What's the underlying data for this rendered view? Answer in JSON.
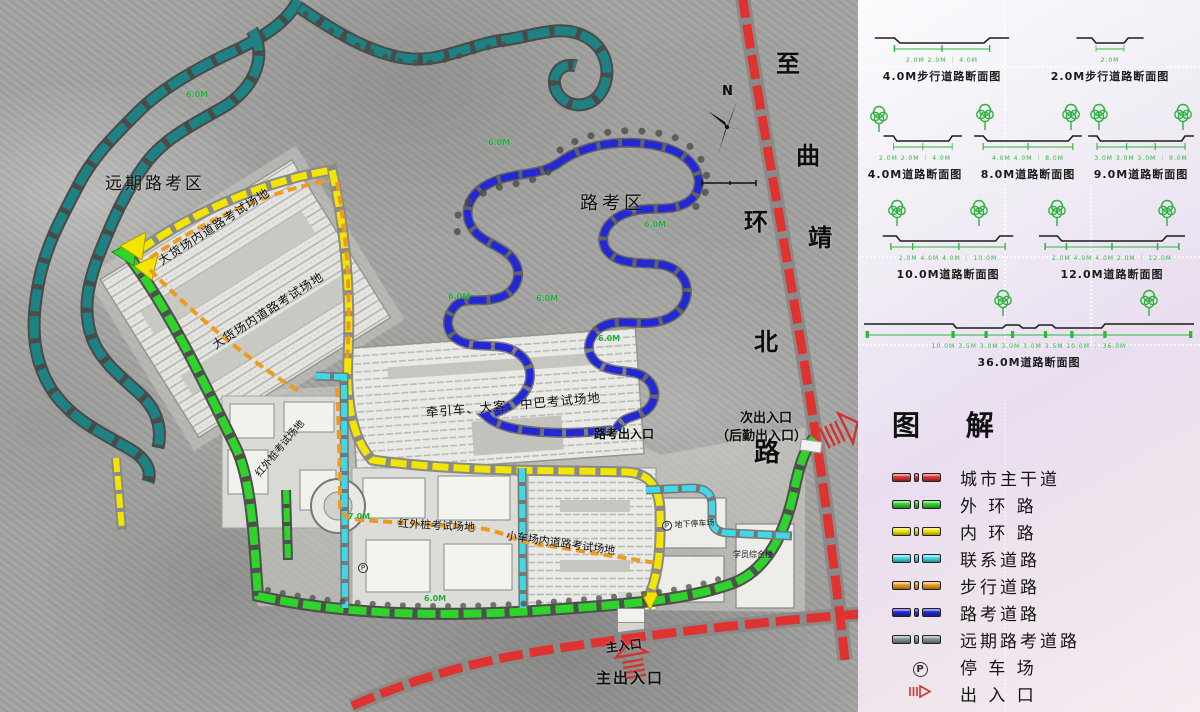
{
  "map": {
    "north_label": "N",
    "parking_symbol": "P",
    "region_labels": {
      "future_test_area": "远期路考区",
      "road_test_area": "路考区",
      "truck_field_a": "大货场内道路考试场地",
      "truck_field_b": "大货场内道路考试场地",
      "tractor_bus_field": "牵引车、大客、中巴考试场地",
      "infrared_pile_field_a": "红外桩考试场地",
      "infrared_pile_field_b": "红外桩考试场地",
      "small_car_field": "小车场内道路考试场地",
      "underground_parking": "地下停车场",
      "student_building": "学员综合楼"
    },
    "road_name": {
      "full": "至曲靖环北路",
      "chars": [
        "至",
        "曲",
        "环",
        "靖",
        "北",
        "路"
      ]
    },
    "entrance_labels": {
      "secondary_line1": "次出入口",
      "secondary_line2": "（后勤出入口）",
      "road_test_exit": "路考出入口",
      "main_gate": "主入口",
      "main_entrance": "主出入口"
    },
    "dimension_labels": [
      "6.0M",
      "6.0M",
      "6.0M",
      "6.0M",
      "6.0M",
      "7.0M",
      "6.0M",
      "6.0M"
    ]
  },
  "panel": {
    "sections": [
      {
        "label": "4.0M步行道路断面图",
        "dims": "2.0M  2.0M ｜ 4.0M"
      },
      {
        "label": "2.0M步行道路断面图",
        "dims": "2.0M"
      },
      {
        "label": "4.0M道路断面图",
        "dims": "2.0M 2.0M ｜ 4.0M"
      },
      {
        "label": "8.0M道路断面图",
        "dims": "4.0M 4.0M ｜ 8.0M"
      },
      {
        "label": "9.0M道路断面图",
        "dims": "3.0M 3.0M 3.0M ｜ 9.0M"
      },
      {
        "label": "10.0M道路断面图",
        "dims": "2.0M 4.0M 4.0M ｜ 10.0M"
      },
      {
        "label": "12.0M道路断面图",
        "dims": "2.0M 4.0M 4.0M 2.0M ｜ 12.0M"
      },
      {
        "label": "36.0M道路断面图",
        "dims": "10.0M 3.5M 3.0M 3.0M 3.0M 3.5M 10.0M ｜ 36.0M"
      }
    ],
    "legend": {
      "title": "图  解",
      "items": [
        {
          "label": "城市主干道",
          "color": "#df3331",
          "type": "dash"
        },
        {
          "label": "外 环 路",
          "color": "#2ed32b",
          "type": "dash"
        },
        {
          "label": "内 环 路",
          "color": "#f2e600",
          "type": "dash"
        },
        {
          "label": "联系道路",
          "color": "#3fd8e8",
          "type": "dash"
        },
        {
          "label": "步行道路",
          "color": "#ee9a1e",
          "type": "dash"
        },
        {
          "label": "路考道路",
          "color": "#2328d6",
          "type": "dash"
        },
        {
          "label": "远期路考道路",
          "color": "#7f9696",
          "type": "dash"
        },
        {
          "label": "停 车 场",
          "symbol": "P",
          "type": "parking"
        },
        {
          "label": "出 入 口",
          "color": "#d23230",
          "type": "arrow"
        }
      ]
    }
  },
  "colors": {
    "city_road": "#df3331",
    "outer_ring": "#2ed32b",
    "inner_ring": "#f2e600",
    "link_road": "#3fd8e8",
    "pedestrian": "#ee9a1e",
    "road_test": "#2328d6",
    "future_test": "#1e8183"
  }
}
